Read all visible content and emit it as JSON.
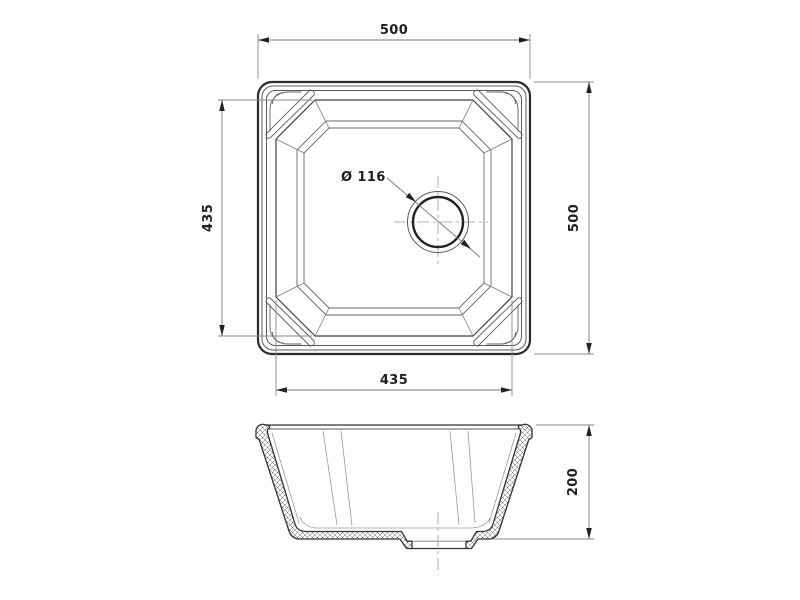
{
  "drawing": {
    "top_view": {
      "overall_width": "500",
      "overall_height": "500",
      "bowl_width": "435",
      "bowl_height": "435",
      "drain_diameter": "Ø 116"
    },
    "side_view": {
      "depth": "200"
    },
    "colors": {
      "background": "#ffffff",
      "object_line": "#2b2b2b",
      "dimension_text": "#1f1f1f",
      "thin_line": "#8a8a8a"
    }
  }
}
